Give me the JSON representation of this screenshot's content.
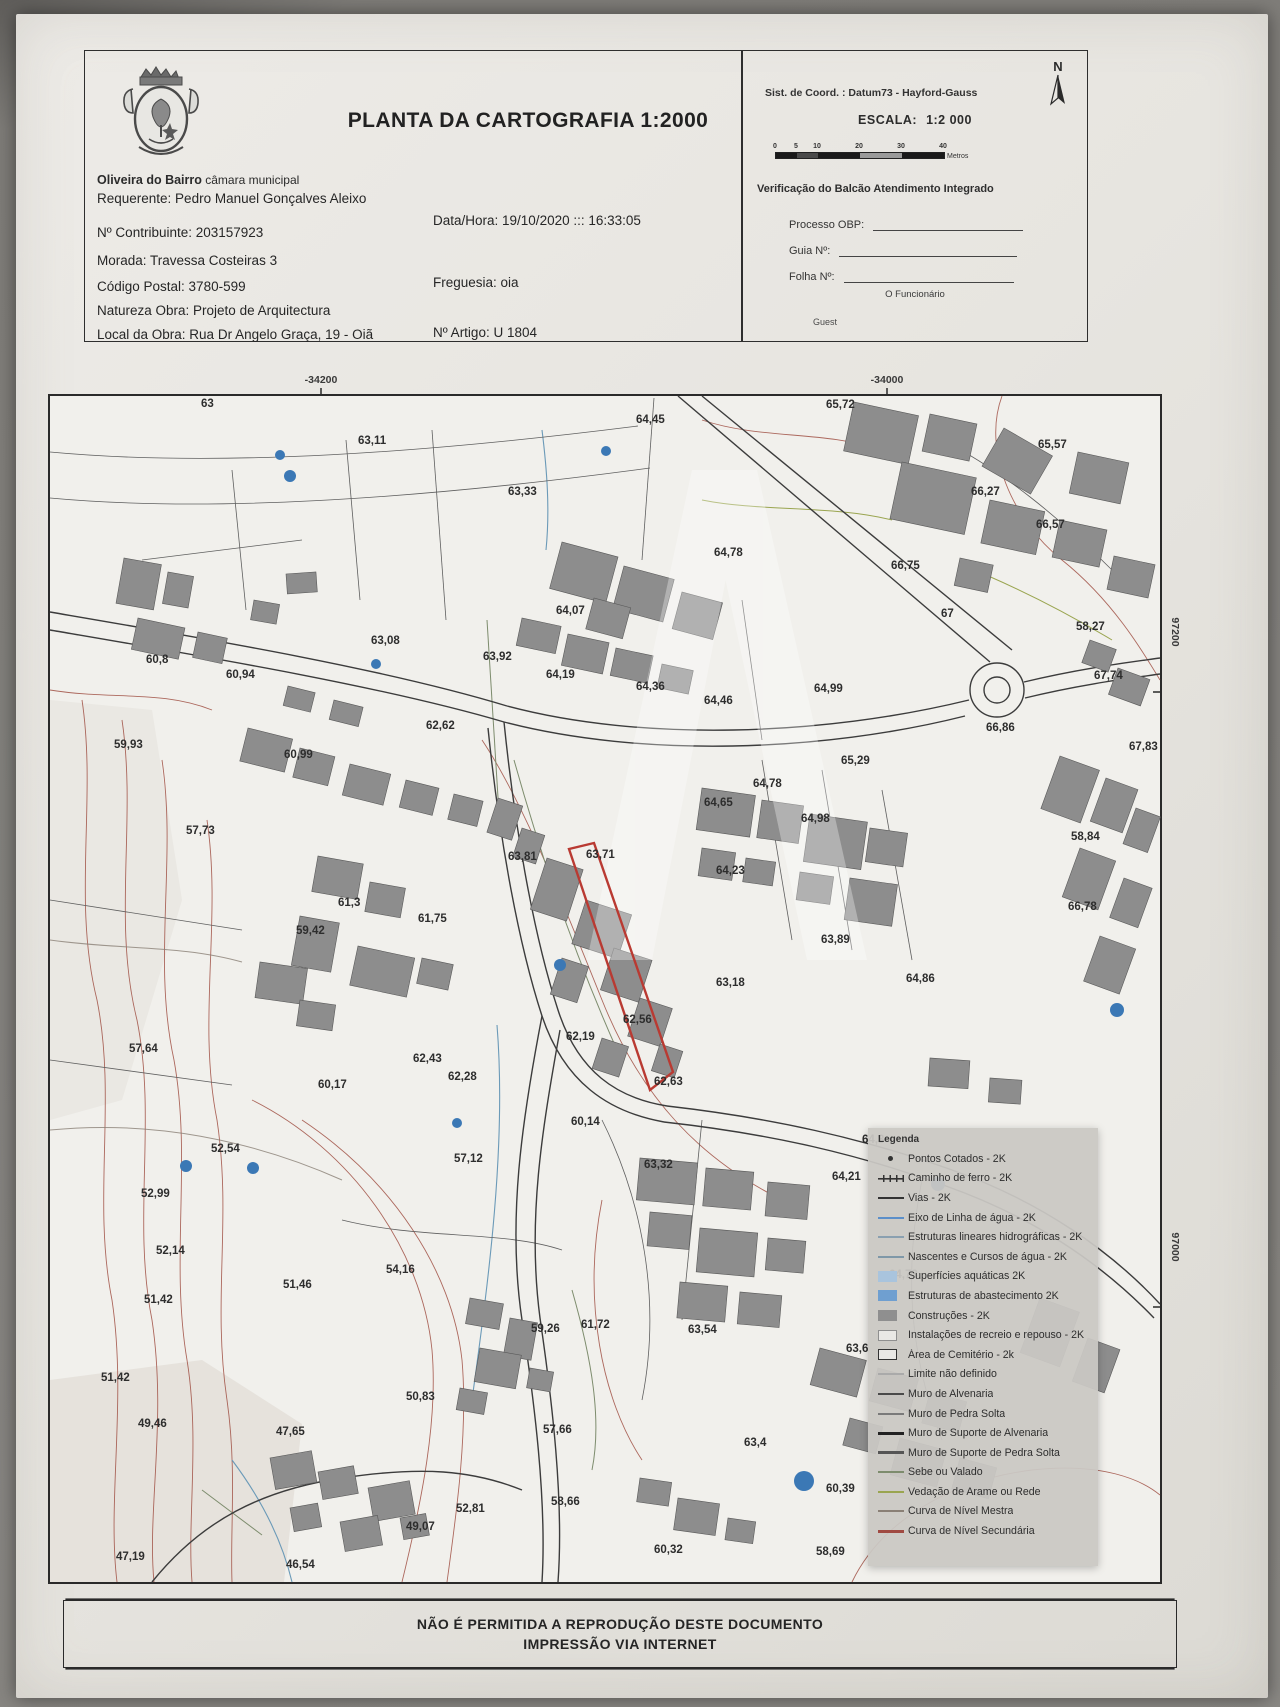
{
  "header": {
    "municipality_bold": "Oliveira do Bairro",
    "municipality_rest": " câmara municipal",
    "title": "PLANTA DA CARTOGRAFIA 1:2000",
    "requerente": "Requerente: Pedro Manuel Gonçalves Aleixo",
    "contribuinte": "Nº Contribuinte: 203157923",
    "data_hora": "Data/Hora: 19/10/2020 ::: 16:33:05",
    "morada": "Morada: Travessa Costeiras 3",
    "codigo_postal": "Código Postal: 3780-599",
    "freguesia": "Freguesia: oia",
    "natureza_obra": "Natureza Obra: Projeto de Arquitectura",
    "local_obra": "Local da Obra: Rua Dr Angelo Graça, 19 - Oiã",
    "artigo": "Nº Artigo: U 1804"
  },
  "info_panel": {
    "coord_system": "Sist. de Coord. : Datum73 -  Hayford-Gauss",
    "escala_label": "ESCALA:",
    "escala_value": "1:2 000",
    "scale_ticks": [
      "0",
      "5",
      "10",
      "20",
      "30",
      "40"
    ],
    "scale_max": 40,
    "scale_unit": "Metros",
    "verification_title": "Verificação do Balcão Atendimento Integrado",
    "processo_label": "Processo OBP:",
    "guia_label": "Guia Nº:",
    "folha_label": "Folha Nº:",
    "funcionario_label": "O Funcionário",
    "signature": "Guest",
    "north_label": "N"
  },
  "map": {
    "top_coords": [
      {
        "text": "-34200",
        "x": 335
      },
      {
        "text": "-34000",
        "x": 901
      }
    ],
    "right_coords": [
      {
        "text": "97200",
        "y": 632
      },
      {
        "text": "97000",
        "y": 1247
      }
    ],
    "highlight_color": "#b93a32",
    "spot_elevations": [
      {
        "t": "63",
        "x": 215,
        "y": 407
      },
      {
        "t": "63,11",
        "x": 372,
        "y": 444
      },
      {
        "t": "63,33",
        "x": 522,
        "y": 495
      },
      {
        "t": "64,45",
        "x": 650,
        "y": 423
      },
      {
        "t": "65,72",
        "x": 840,
        "y": 408
      },
      {
        "t": "65,57",
        "x": 1052,
        "y": 448
      },
      {
        "t": "66,27",
        "x": 985,
        "y": 495
      },
      {
        "t": "66,57",
        "x": 1050,
        "y": 528
      },
      {
        "t": "64,78",
        "x": 728,
        "y": 556
      },
      {
        "t": "66,75",
        "x": 905,
        "y": 569
      },
      {
        "t": "64,07",
        "x": 570,
        "y": 614
      },
      {
        "t": "67",
        "x": 955,
        "y": 617
      },
      {
        "t": "58,27",
        "x": 1090,
        "y": 630
      },
      {
        "t": "63,08",
        "x": 385,
        "y": 644
      },
      {
        "t": "63,92",
        "x": 497,
        "y": 660
      },
      {
        "t": "60,8",
        "x": 160,
        "y": 663
      },
      {
        "t": "60,94",
        "x": 240,
        "y": 678
      },
      {
        "t": "64,19",
        "x": 560,
        "y": 678
      },
      {
        "t": "64,36",
        "x": 650,
        "y": 690
      },
      {
        "t": "64,46",
        "x": 718,
        "y": 704
      },
      {
        "t": "64,99",
        "x": 828,
        "y": 692
      },
      {
        "t": "67,74",
        "x": 1108,
        "y": 679
      },
      {
        "t": "66,86",
        "x": 1000,
        "y": 731
      },
      {
        "t": "62,62",
        "x": 440,
        "y": 729
      },
      {
        "t": "59,93",
        "x": 128,
        "y": 748
      },
      {
        "t": "60,99",
        "x": 298,
        "y": 758
      },
      {
        "t": "65,29",
        "x": 855,
        "y": 764
      },
      {
        "t": "64,78",
        "x": 767,
        "y": 787
      },
      {
        "t": "67,83",
        "x": 1143,
        "y": 750
      },
      {
        "t": "64,65",
        "x": 718,
        "y": 806
      },
      {
        "t": "64,98",
        "x": 815,
        "y": 822
      },
      {
        "t": "63,81",
        "x": 522,
        "y": 860
      },
      {
        "t": "63,71",
        "x": 600,
        "y": 858
      },
      {
        "t": "58,84",
        "x": 1085,
        "y": 840
      },
      {
        "t": "57,73",
        "x": 200,
        "y": 834
      },
      {
        "t": "64,23",
        "x": 730,
        "y": 874
      },
      {
        "t": "61,75",
        "x": 432,
        "y": 922
      },
      {
        "t": "61,3",
        "x": 352,
        "y": 906
      },
      {
        "t": "59,42",
        "x": 310,
        "y": 934
      },
      {
        "t": "63,89",
        "x": 835,
        "y": 943
      },
      {
        "t": "66,78",
        "x": 1082,
        "y": 910
      },
      {
        "t": "62,56",
        "x": 637,
        "y": 1023
      },
      {
        "t": "63,18",
        "x": 730,
        "y": 986
      },
      {
        "t": "64,86",
        "x": 920,
        "y": 982
      },
      {
        "t": "57,64",
        "x": 143,
        "y": 1052
      },
      {
        "t": "62,19",
        "x": 580,
        "y": 1040
      },
      {
        "t": "62,43",
        "x": 427,
        "y": 1062
      },
      {
        "t": "62,28",
        "x": 462,
        "y": 1080
      },
      {
        "t": "60,17",
        "x": 332,
        "y": 1088
      },
      {
        "t": "52,54",
        "x": 225,
        "y": 1152
      },
      {
        "t": "57,12",
        "x": 468,
        "y": 1162
      },
      {
        "t": "62,63",
        "x": 668,
        "y": 1085
      },
      {
        "t": "60,14",
        "x": 585,
        "y": 1125
      },
      {
        "t": "64,3",
        "x": 876,
        "y": 1143
      },
      {
        "t": "64,21",
        "x": 846,
        "y": 1180
      },
      {
        "t": "52,99",
        "x": 155,
        "y": 1197
      },
      {
        "t": "63,32",
        "x": 658,
        "y": 1168
      },
      {
        "t": "54,16",
        "x": 400,
        "y": 1273
      },
      {
        "t": "51,46",
        "x": 297,
        "y": 1288
      },
      {
        "t": "64,73",
        "x": 903,
        "y": 1278
      },
      {
        "t": "52,14",
        "x": 170,
        "y": 1254
      },
      {
        "t": "59,26",
        "x": 545,
        "y": 1332
      },
      {
        "t": "61,72",
        "x": 595,
        "y": 1328
      },
      {
        "t": "63,54",
        "x": 702,
        "y": 1333
      },
      {
        "t": "63,6",
        "x": 860,
        "y": 1352
      },
      {
        "t": "51,42",
        "x": 158,
        "y": 1303
      },
      {
        "t": "57,66",
        "x": 557,
        "y": 1433
      },
      {
        "t": "63,4",
        "x": 758,
        "y": 1446
      },
      {
        "t": "51,42",
        "x": 115,
        "y": 1381
      },
      {
        "t": "50,83",
        "x": 420,
        "y": 1400
      },
      {
        "t": "49,46",
        "x": 152,
        "y": 1427
      },
      {
        "t": "47,65",
        "x": 290,
        "y": 1435
      },
      {
        "t": "60,39",
        "x": 840,
        "y": 1492
      },
      {
        "t": "58,66",
        "x": 565,
        "y": 1505
      },
      {
        "t": "52,81",
        "x": 470,
        "y": 1512
      },
      {
        "t": "49,07",
        "x": 420,
        "y": 1530
      },
      {
        "t": "58,69",
        "x": 830,
        "y": 1555
      },
      {
        "t": "60,32",
        "x": 668,
        "y": 1553
      },
      {
        "t": "47,19",
        "x": 130,
        "y": 1560
      },
      {
        "t": "46,54",
        "x": 300,
        "y": 1568
      }
    ]
  },
  "legend": {
    "title": "Legenda",
    "items": [
      {
        "label": "Pontos Cotados - 2K",
        "kind": "point",
        "color": "#333333"
      },
      {
        "label": "Caminho de ferro - 2K",
        "kind": "rail",
        "color": "#333333"
      },
      {
        "label": "Vias - 2K",
        "kind": "line",
        "color": "#333333"
      },
      {
        "label": "Eixo de Linha de água - 2K",
        "kind": "line",
        "color": "#5b8fc9"
      },
      {
        "label": "Estruturas lineares hidrográficas - 2K",
        "kind": "line",
        "color": "#8aa0b0"
      },
      {
        "label": "Nascentes e Cursos de água - 2K",
        "kind": "line",
        "color": "#7f98a8"
      },
      {
        "label": "Superfícies aquáticas 2K",
        "kind": "box",
        "color": "#a9c4dd"
      },
      {
        "label": "Estruturas de abastecimento 2K",
        "kind": "box",
        "color": "#6f9fd0"
      },
      {
        "label": "Construções - 2K",
        "kind": "box",
        "color": "#8f8f8f"
      },
      {
        "label": "Instalações de recreio e repouso - 2K",
        "kind": "outline",
        "color": "#8f8f8f"
      },
      {
        "label": "Área de Cemitério - 2k",
        "kind": "outline",
        "color": "#333333"
      },
      {
        "label": "Limite não definido",
        "kind": "line",
        "color": "#aaaaaa"
      },
      {
        "label": "Muro de Alvenaria",
        "kind": "line",
        "color": "#4a4a4a"
      },
      {
        "label": "Muro de Pedra Solta",
        "kind": "line",
        "color": "#7a7a7a"
      },
      {
        "label": "Muro de Suporte de Alvenaria",
        "kind": "thick",
        "color": "#222222"
      },
      {
        "label": "Muro de Suporte de Pedra Solta",
        "kind": "thick",
        "color": "#555555"
      },
      {
        "label": "Sebe ou Valado",
        "kind": "line",
        "color": "#7d8c6d"
      },
      {
        "label": "Vedação de Arame ou Rede",
        "kind": "line",
        "color": "#9aa550"
      },
      {
        "label": "Curva de Nível Mestra",
        "kind": "line",
        "color": "#8a8076"
      },
      {
        "label": "Curva de Nível Secundária",
        "kind": "thick",
        "color": "#a04a42"
      }
    ]
  },
  "footer": {
    "line1": "NÃO É PERMITIDA A REPRODUÇÃO DESTE DOCUMENTO",
    "line2": "IMPRESSÃO VIA INTERNET"
  }
}
